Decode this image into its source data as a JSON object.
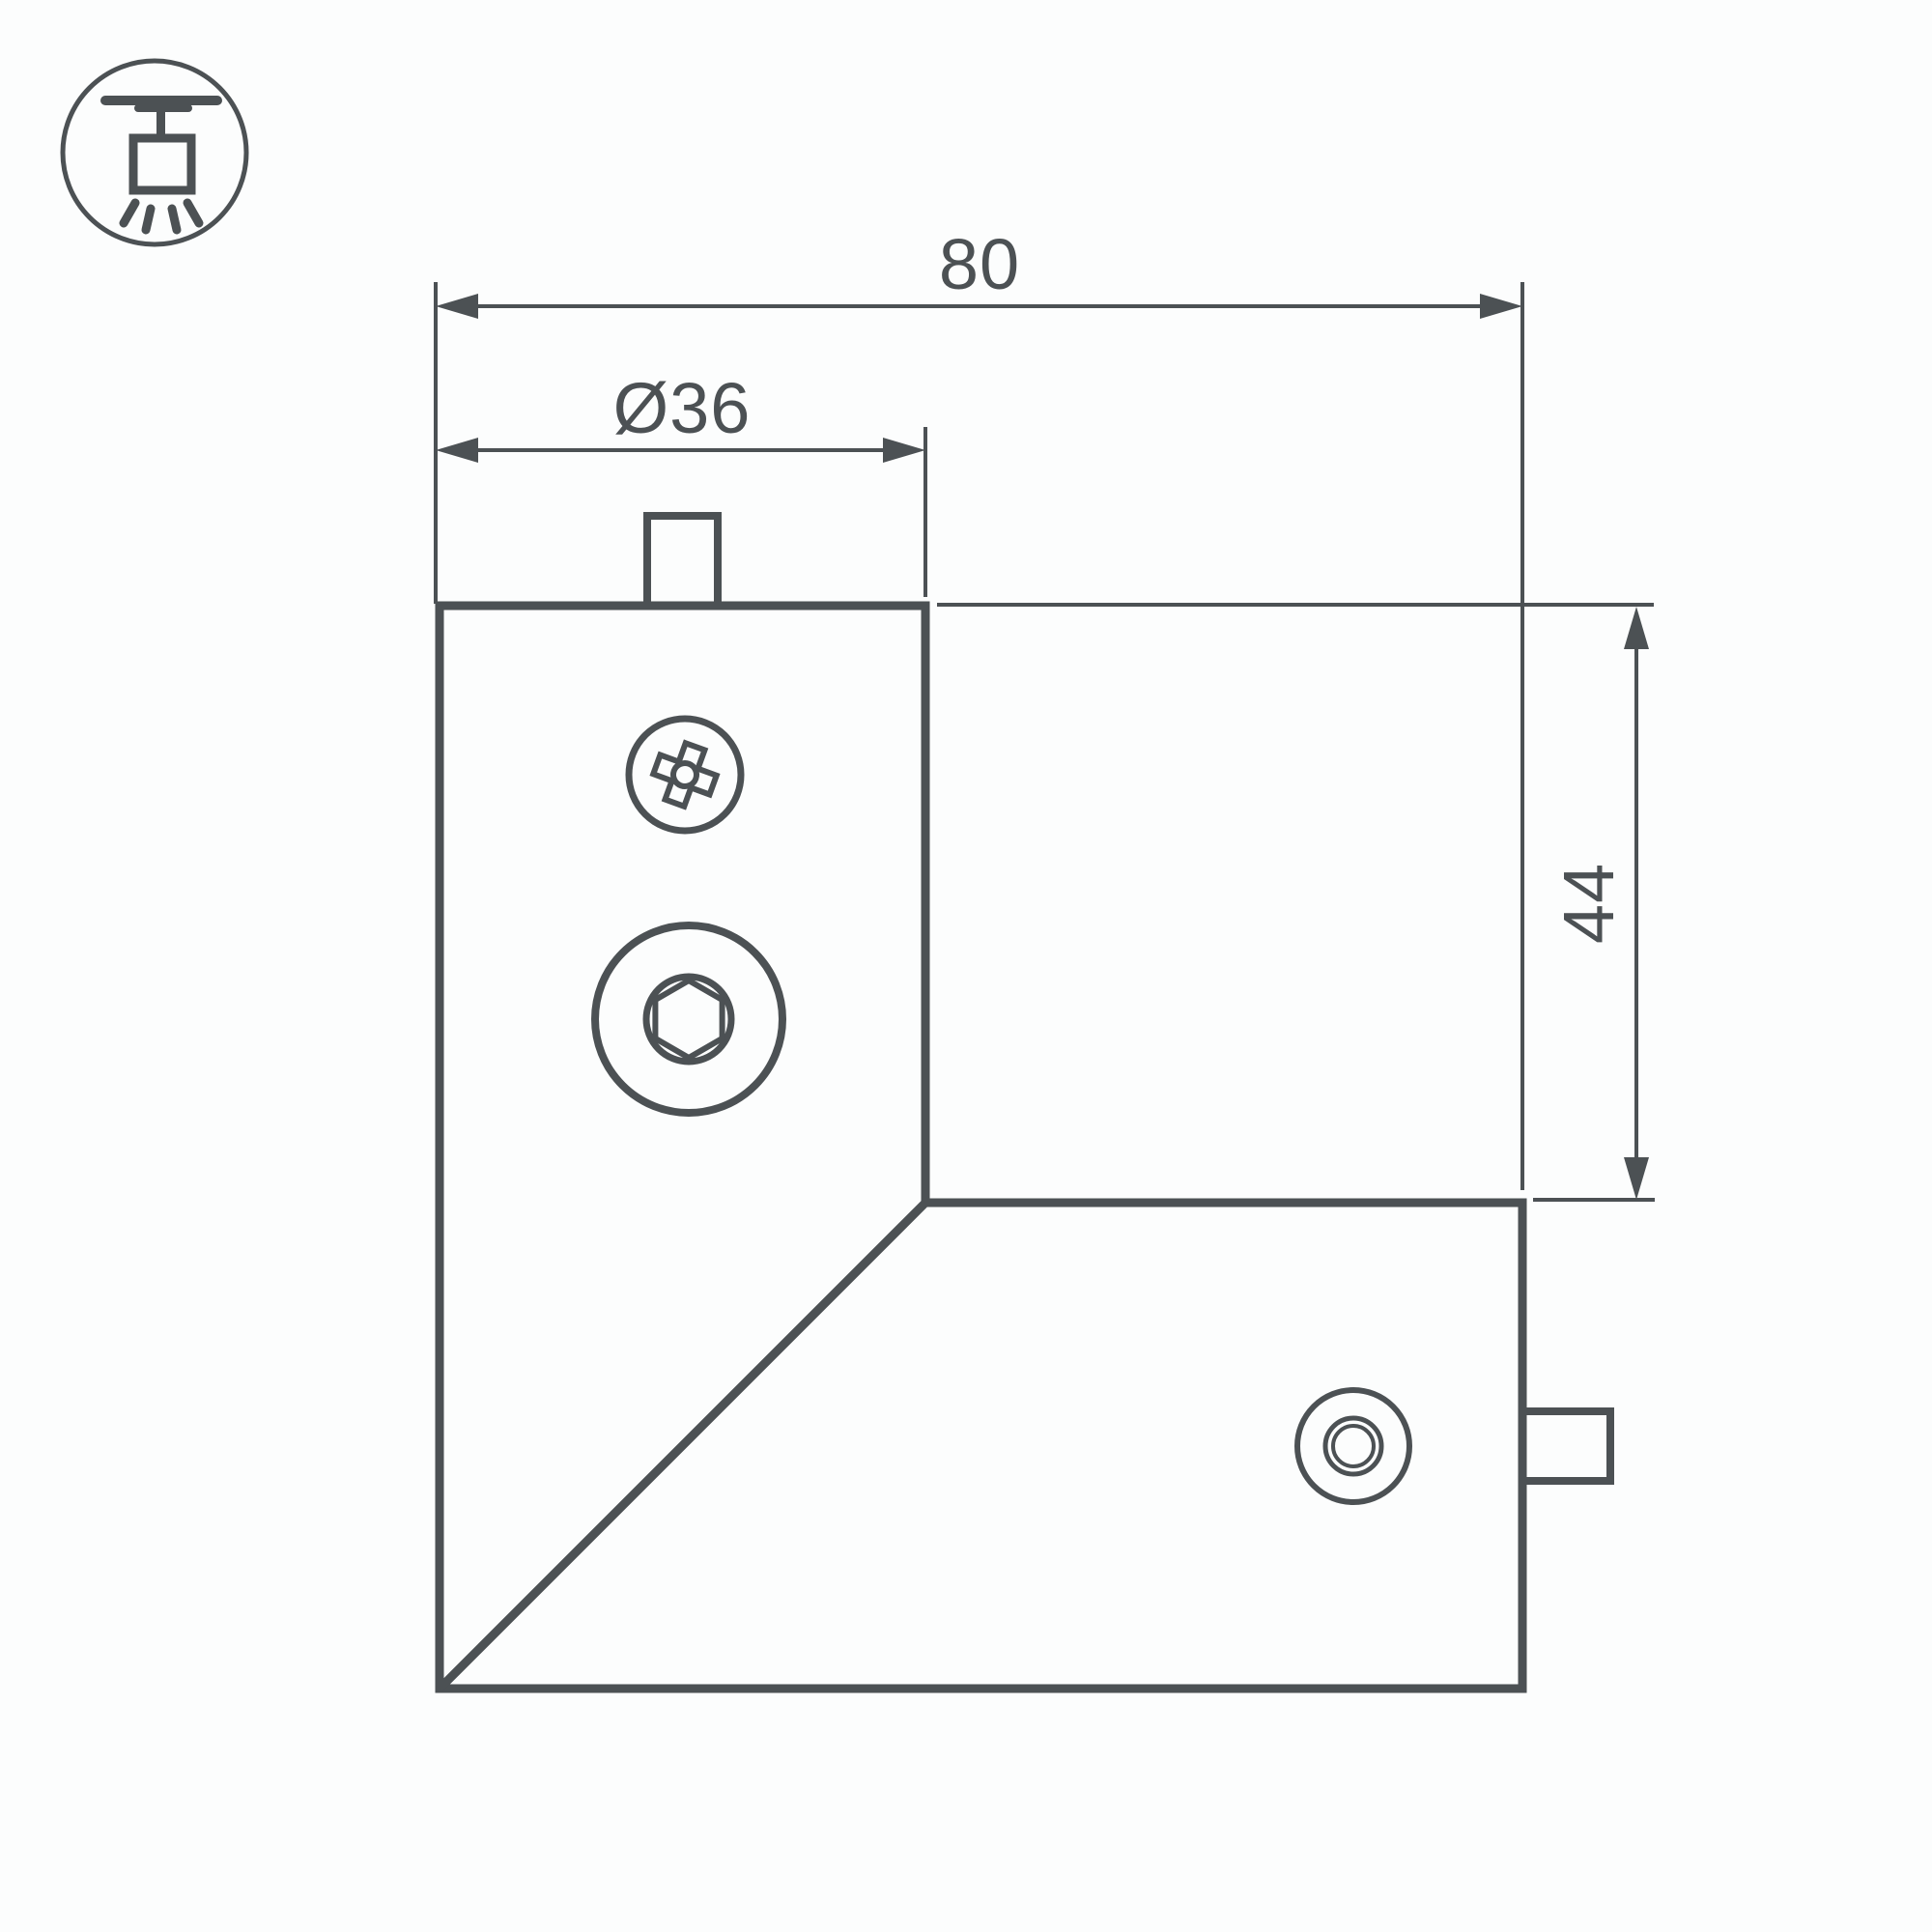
{
  "drawing": {
    "background": "#fcfdfd",
    "line_color": "#4c5154",
    "icon": {
      "name": "ceiling-track-light-icon"
    },
    "dimensions": {
      "top_width": "80",
      "connector_diameter": "Ø36",
      "side_height": "44"
    }
  }
}
